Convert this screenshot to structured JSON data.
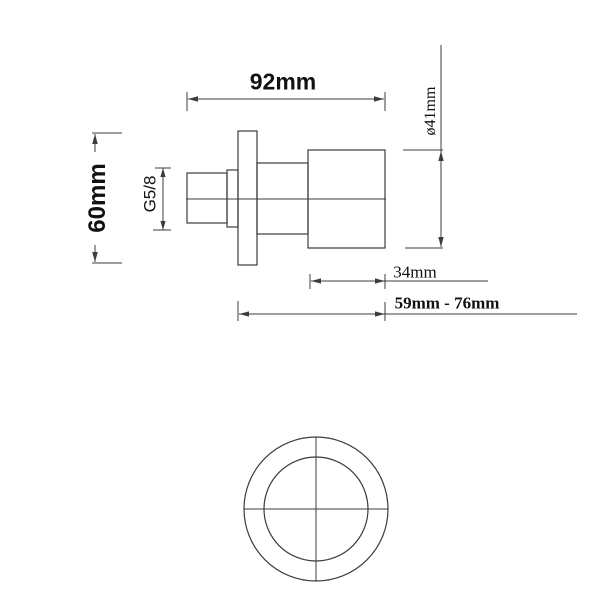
{
  "colors": {
    "line": "#3c3c3c",
    "text": "#111111",
    "background": "#ffffff"
  },
  "side_view": {
    "labels": {
      "total_length": "92mm",
      "flange_diameter": "60mm",
      "thread_size": "G5/8",
      "body_diameter": "ø41mm",
      "body_length": "34mm",
      "depth_range": "59mm - 76mm"
    }
  }
}
